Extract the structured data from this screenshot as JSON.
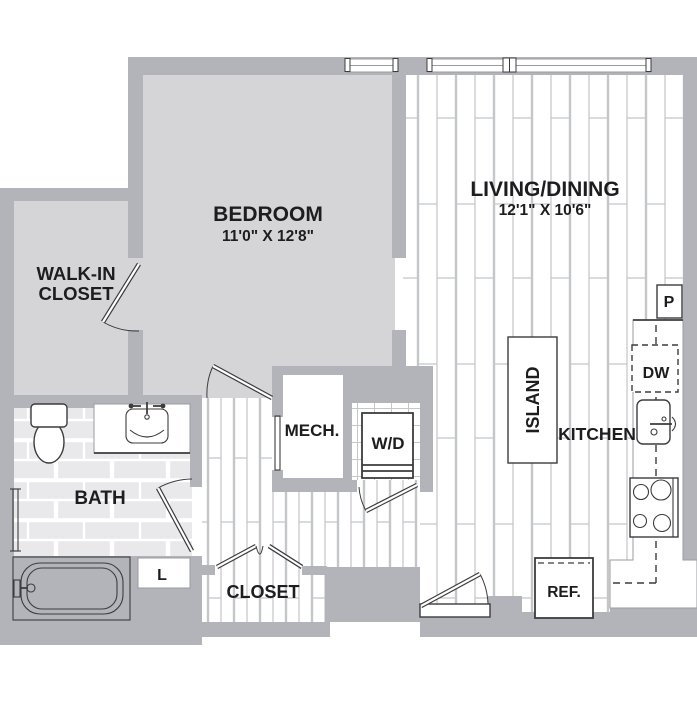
{
  "title": "One-bedroom apartment floor plan",
  "colors": {
    "wall": "#b2b4b9",
    "room_fill": "#d5d5d7",
    "plank_line": "#c5c6c9",
    "tile_fill": "#e9e9eb",
    "tile_line": "#ffffff",
    "outline": "#3c3c3e",
    "counter_line": "#9a9b9e",
    "text": "#1d1d1f"
  },
  "rooms": {
    "bedroom": {
      "name": "BEDROOM",
      "dims": "11'0\" X 12'8\""
    },
    "living_dining": {
      "name": "LIVING/DINING",
      "dims": "12'1\" X 10'6\""
    },
    "walk_in_closet": {
      "line1": "WALK-IN",
      "line2": "CLOSET"
    },
    "bath": {
      "name": "BATH"
    },
    "kitchen": {
      "name": "KITCHEN"
    },
    "closet": {
      "name": "CLOSET"
    },
    "mech": {
      "name": "MECH."
    }
  },
  "fixtures": {
    "island": "ISLAND",
    "washer_dryer": "W/D",
    "dishwasher": "DW",
    "refrigerator": "REF.",
    "pantry": "P",
    "linen": "L"
  }
}
